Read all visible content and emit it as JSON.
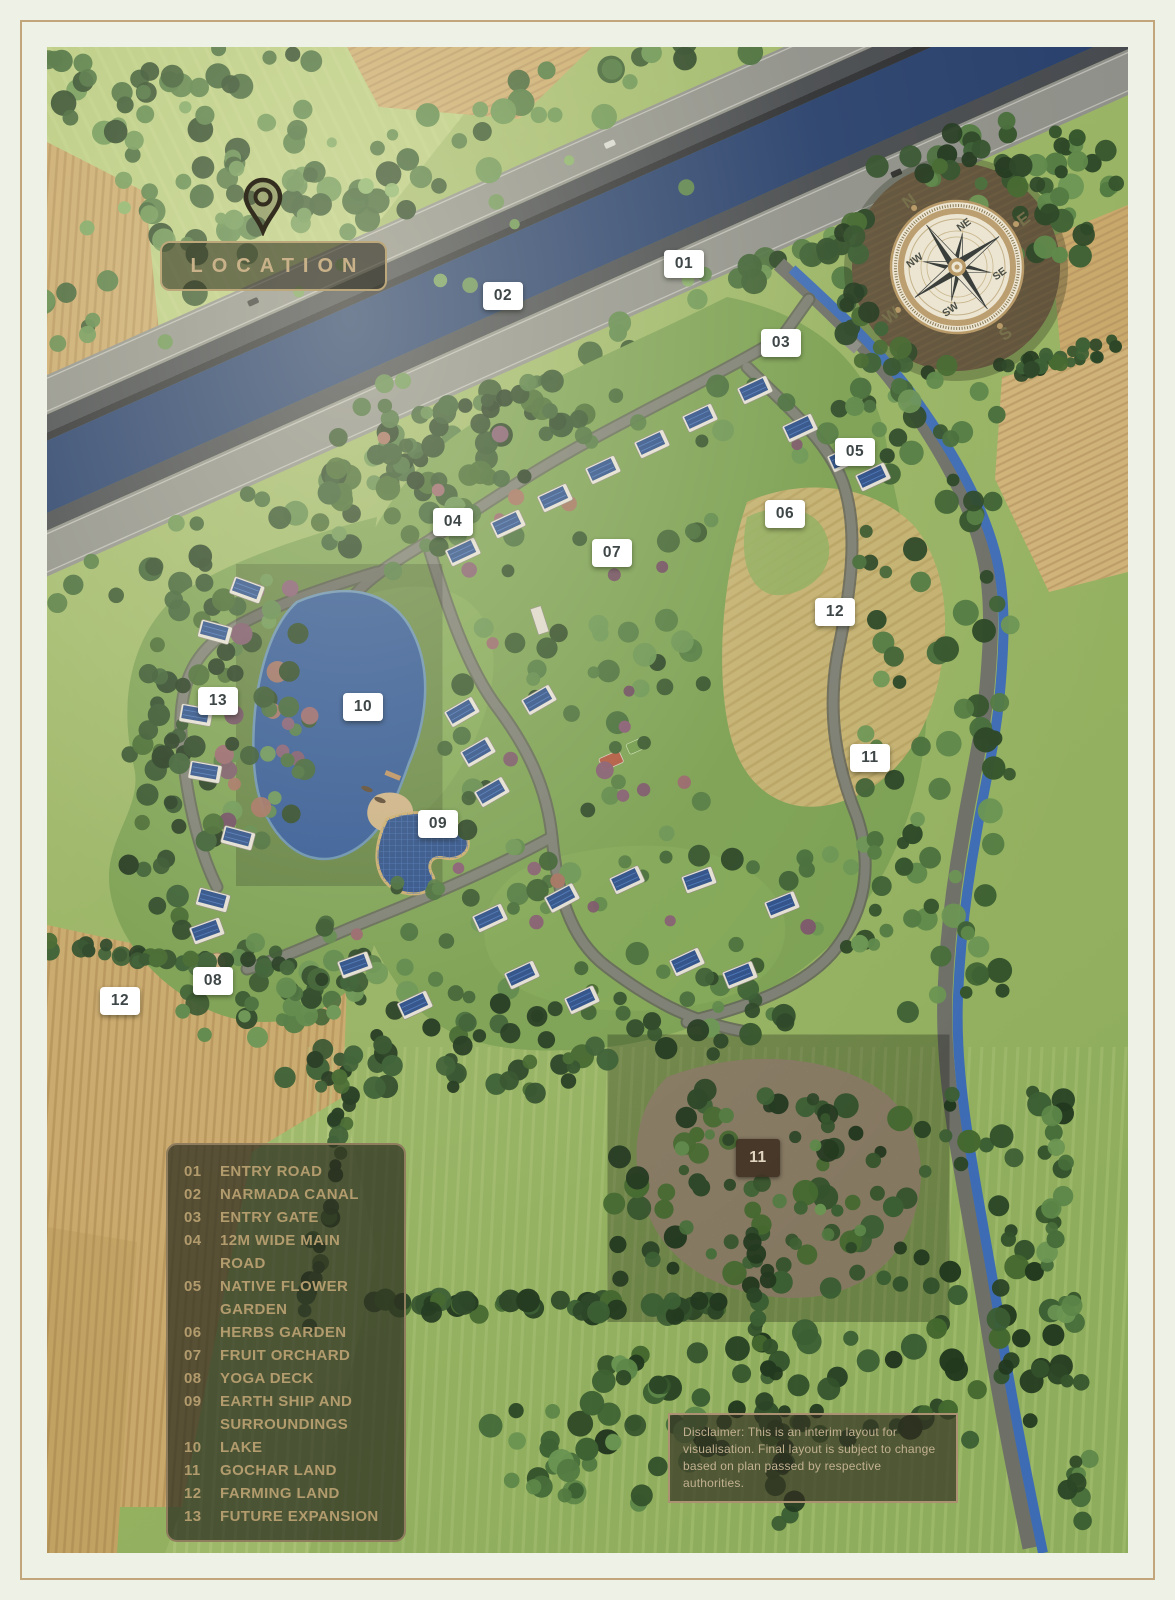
{
  "title": {
    "label": "LOCATION"
  },
  "legend": {
    "items": [
      {
        "num": "01",
        "label": "ENTRY ROAD"
      },
      {
        "num": "02",
        "label": "NARMADA CANAL"
      },
      {
        "num": "03",
        "label": "ENTRY GATE"
      },
      {
        "num": "04",
        "label": "12M WIDE MAIN ROAD"
      },
      {
        "num": "05",
        "label": "NATIVE FLOWER GARDEN"
      },
      {
        "num": "06",
        "label": "HERBS GARDEN"
      },
      {
        "num": "07",
        "label": "FRUIT ORCHARD"
      },
      {
        "num": "08",
        "label": "YOGA DECK"
      },
      {
        "num": "09",
        "label": "EARTH SHIP AND SURROUNDINGS"
      },
      {
        "num": "10",
        "label": "LAKE"
      },
      {
        "num": "11",
        "label": "GOCHAR LAND"
      },
      {
        "num": "12",
        "label": "FARMING LAND"
      },
      {
        "num": "13",
        "label": "FUTURE EXPANSION"
      }
    ]
  },
  "markers": [
    {
      "label": "01",
      "x": 684,
      "y": 264,
      "variant": "light"
    },
    {
      "label": "02",
      "x": 503,
      "y": 296,
      "variant": "light"
    },
    {
      "label": "03",
      "x": 781,
      "y": 343,
      "variant": "light"
    },
    {
      "label": "04",
      "x": 453,
      "y": 522,
      "variant": "light"
    },
    {
      "label": "05",
      "x": 855,
      "y": 452,
      "variant": "light"
    },
    {
      "label": "06",
      "x": 785,
      "y": 514,
      "variant": "light"
    },
    {
      "label": "07",
      "x": 612,
      "y": 553,
      "variant": "light"
    },
    {
      "label": "12",
      "x": 835,
      "y": 612,
      "variant": "light"
    },
    {
      "label": "13",
      "x": 218,
      "y": 701,
      "variant": "light"
    },
    {
      "label": "10",
      "x": 363,
      "y": 707,
      "variant": "light"
    },
    {
      "label": "11",
      "x": 870,
      "y": 758,
      "variant": "light"
    },
    {
      "label": "09",
      "x": 438,
      "y": 824,
      "variant": "light"
    },
    {
      "label": "08",
      "x": 213,
      "y": 981,
      "variant": "light"
    },
    {
      "label": "12",
      "x": 120,
      "y": 1001,
      "variant": "light"
    },
    {
      "label": "11",
      "x": 758,
      "y": 1158,
      "variant": "dark"
    }
  ],
  "compass": {
    "rotation_deg": -36,
    "cardinals": [
      {
        "label": "N",
        "angle": 0
      },
      {
        "label": "E",
        "angle": 90
      },
      {
        "label": "S",
        "angle": 180
      },
      {
        "label": "W",
        "angle": 270
      }
    ],
    "intercardinals": [
      {
        "label": "NE",
        "angle": 45
      },
      {
        "label": "SE",
        "angle": 135
      },
      {
        "label": "SW",
        "angle": 225
      },
      {
        "label": "NW",
        "angle": 315
      }
    ]
  },
  "disclaimer": {
    "text": "Disclaimer: This is an interim layout for visualisation. Final layout is subject to change based on plan passed by respective authorities."
  },
  "colors": {
    "accent_tan": "#bda87c",
    "legend_text": "#b29b6d",
    "marker_text": "#3e4647",
    "canal_water": "#3f63a8",
    "lake_water": "#3e6db6"
  }
}
